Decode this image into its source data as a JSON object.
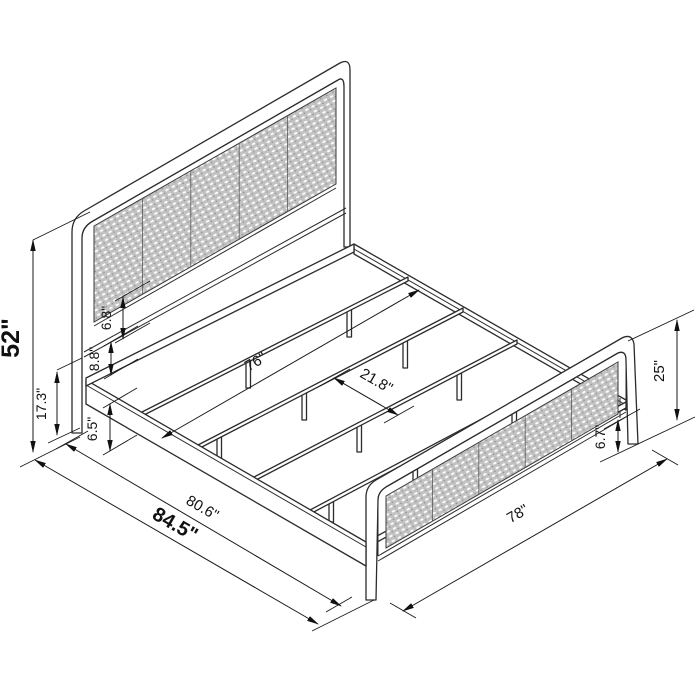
{
  "diagram": {
    "kind": "isometric product dimension drawing",
    "product": "metal platform bed frame with cane headboard and footboard",
    "unit": "inches",
    "line_color": "#2b2b2b",
    "cane_fill": "#c2c2c2",
    "background": "#ffffff"
  },
  "labels": {
    "headboard_height": "52\"",
    "rail_floor_height": "17.3\"",
    "underbed_clearance": "6.5\"",
    "headboard_lower_band": "8.8\"",
    "headboard_panel_gap": "6.8\"",
    "slat_length": "76\"",
    "slat_spacing": "21.8\"",
    "footboard_height": "25\"",
    "footboard_clearance": "6.7\"",
    "frame_length": "80.6\"",
    "overall_length": "84.5\"",
    "overall_width": "78\""
  }
}
